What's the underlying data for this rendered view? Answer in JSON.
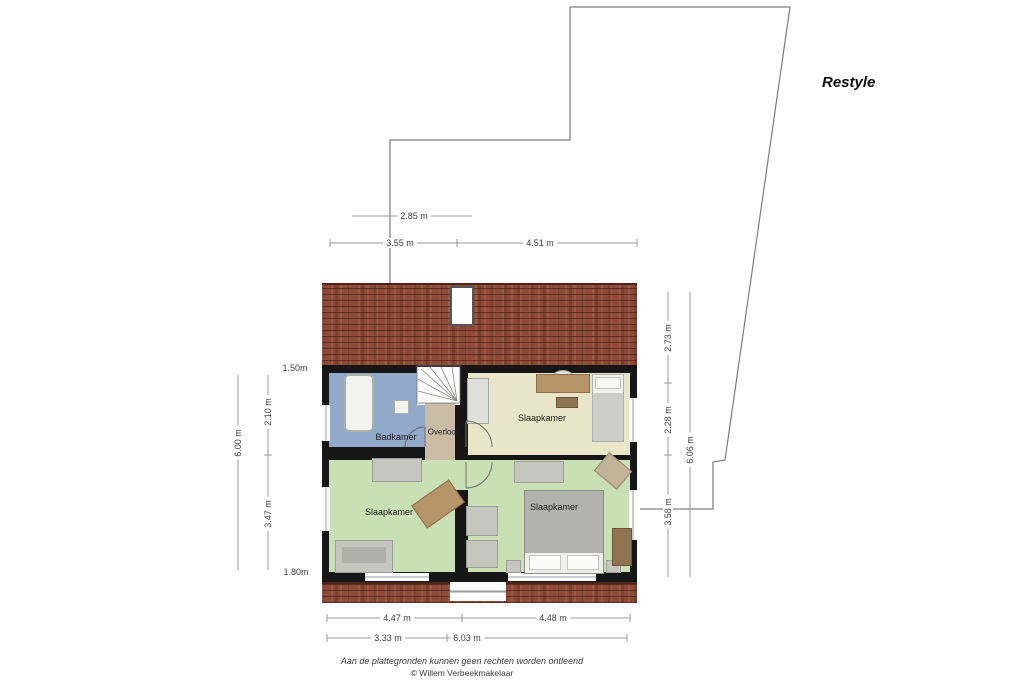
{
  "title": "Restyle",
  "floorplan": {
    "rooms": [
      {
        "id": "badkamer",
        "label": "Badkamer"
      },
      {
        "id": "overloop",
        "label": "Overloop"
      },
      {
        "id": "slaapkamer-top-right",
        "label": "Slaapkamer"
      },
      {
        "id": "slaapkamer-bottom-left",
        "label": "Slaapkamer"
      },
      {
        "id": "slaapkamer-bottom-right",
        "label": "Slaapkamer"
      }
    ]
  },
  "dimensions": {
    "top_setback": "2.85 m",
    "top_left": "3.55 m",
    "top_right": "4.51 m",
    "left_headroom_top": "1.50m",
    "left_upper": "2.10 m",
    "left_total": "6.00 m",
    "left_lower": "3.47 m",
    "left_headroom_bottom": "1.80m",
    "right_roof": "2.73 m",
    "right_upper": "2.28 m",
    "right_total": "6.06 m",
    "right_lower": "3.58 m",
    "bottom_row1_left": "4.47 m",
    "bottom_row1_right": "4.48 m",
    "bottom_row2_left": "3.33 m",
    "bottom_row2_right": "6.03 m"
  },
  "footer": {
    "disclaimer": "Aan de plattegronden kunnen geen rechten worden ontleend",
    "copyright": "© Willem Verbeekmakelaar"
  },
  "colors": {
    "roof": "#8d4a38",
    "wall": "#161616",
    "bathroom_floor": "#92aac9",
    "landing_floor": "#c9bba4",
    "bedroom_cream_floor": "#e9e5c9",
    "bedroom_green_floor": "#c8e0b4",
    "dimension_line": "#9a9a9a",
    "boundary_line": "#7d7d7d"
  }
}
